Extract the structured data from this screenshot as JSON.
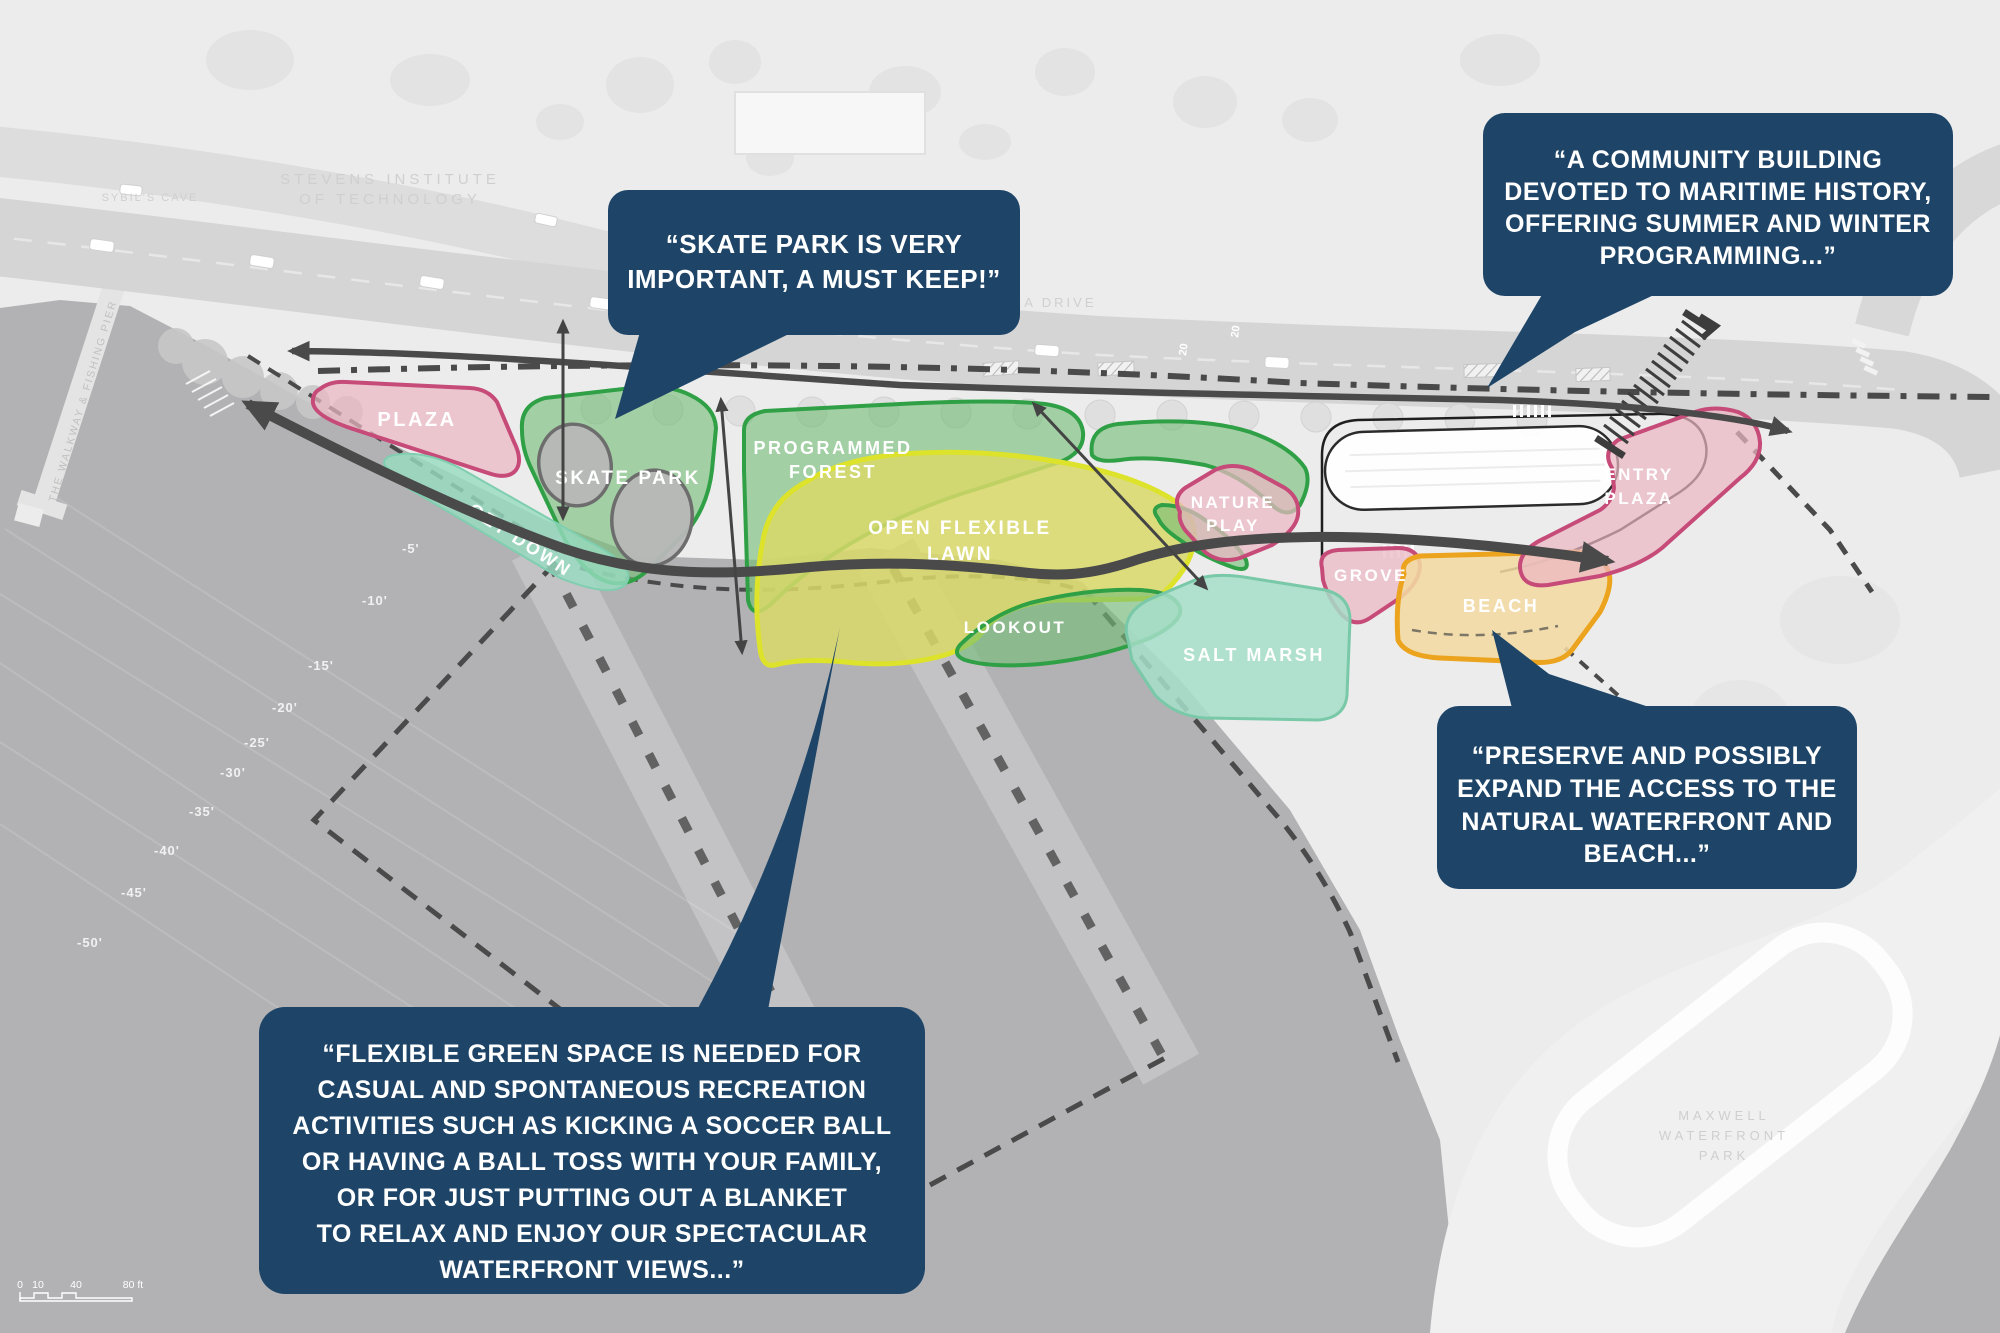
{
  "title": "Waterfront park concept plan with community feedback callouts",
  "callouts": [
    {
      "id": "skate-park",
      "lines": [
        "“SKATE PARK IS VERY",
        "IMPORTANT, A MUST KEEP!”"
      ]
    },
    {
      "id": "community-building",
      "lines": [
        "“A COMMUNITY BUILDING",
        "DEVOTED TO MARITIME HISTORY,",
        "OFFERING SUMMER AND WINTER",
        "PROGRAMMING...”"
      ]
    },
    {
      "id": "beach-access",
      "lines": [
        "“PRESERVE AND POSSIBLY",
        "EXPAND THE ACCESS TO THE",
        "NATURAL WATERFRONT AND",
        "BEACH...”"
      ]
    },
    {
      "id": "flexible-green-space",
      "lines": [
        "“FLEXIBLE GREEN SPACE IS NEEDED FOR",
        "CASUAL AND SPONTANEOUS RECREATION",
        "ACTIVITIES SUCH AS KICKING A SOCCER BALL",
        "OR HAVING A BALL TOSS WITH YOUR FAMILY,",
        "OR FOR JUST PUTTING OUT A BLANKET",
        "TO RELAX AND ENJOY OUR SPECTACULAR",
        "WATERFRONT VIEWS...”"
      ]
    }
  ],
  "map": {
    "zones": [
      {
        "id": "plaza",
        "label": "PLAZA"
      },
      {
        "id": "skate-park",
        "label": "SKATE PARK"
      },
      {
        "id": "get-down",
        "label": "GET DOWN"
      },
      {
        "id": "programmed-forest",
        "lines": [
          "PROGRAMMED",
          "FOREST"
        ]
      },
      {
        "id": "open-flexible-lawn",
        "lines": [
          "OPEN FLEXIBLE",
          "LAWN"
        ]
      },
      {
        "id": "lookout",
        "label": "LOOKOUT"
      },
      {
        "id": "nature-play",
        "lines": [
          "NATURE",
          "PLAY"
        ]
      },
      {
        "id": "grove",
        "label": "GROVE"
      },
      {
        "id": "salt-marsh",
        "label": "SALT MARSH"
      },
      {
        "id": "beach",
        "label": "BEACH"
      },
      {
        "id": "entry-plaza",
        "lines": [
          "ENTRY",
          "PLAZA"
        ]
      }
    ],
    "background_labels": {
      "stevens_line1": "STEVENS INSTITUTE",
      "stevens_line2": "OF TECHNOLOGY",
      "sybils_cave": "SYBIL'S CAVE",
      "street": "SINATRA DRIVE",
      "pier": "THE WALKWAY & FISHING PIER",
      "maxwell_line1": "MAXWELL",
      "maxwell_line2": "WATERFRONT",
      "maxwell_line3": "PARK",
      "speed_limit_a": "20",
      "speed_limit_b": "20"
    },
    "depth_markers": [
      "-5'",
      "-10'",
      "-15'",
      "-20'",
      "-25'",
      "-30'",
      "-35'",
      "-40'",
      "-45'",
      "-50'"
    ],
    "scale_bar": {
      "tick0": "0",
      "tick1": "10",
      "tick2": "40",
      "tick3": "80 ft"
    }
  },
  "palette": {
    "navy": "#1e4568",
    "pink-fill": "#ecb7c4",
    "pink-stroke": "#c64b78",
    "green-fill": "#74bd78",
    "green-stroke": "#2fa045",
    "mint-fill": "#97dcc1",
    "yellow-fill": "#d9d968",
    "yellow-stroke": "#dde22b",
    "sand-fill": "#f3d9a2",
    "sand-stroke": "#eca31d",
    "water": "#b2b2b4",
    "land": "#ececec",
    "road": "#d5d5d5",
    "path": "#4a4a4a"
  }
}
